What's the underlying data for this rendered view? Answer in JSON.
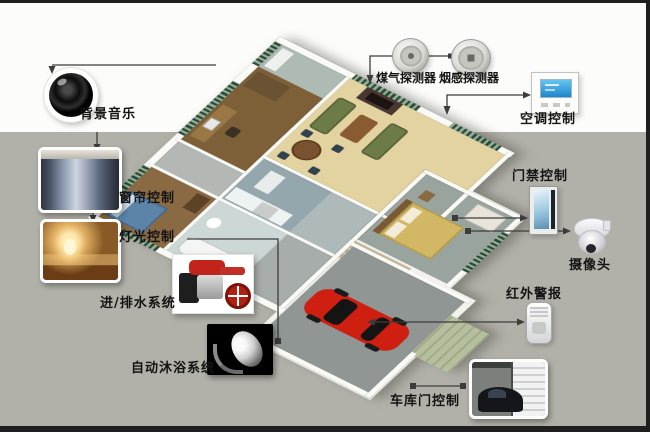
{
  "diagram": {
    "type": "smart-home-system-diagram",
    "scene": "isometric-house-floorplan"
  },
  "callouts": {
    "background_music": {
      "label": "背景音乐",
      "icon": "speaker-icon"
    },
    "curtain_control": {
      "label": "窗帘控制",
      "icon": "curtain-photo"
    },
    "light_control": {
      "label": "灯光控制",
      "icon": "lamp-room-photo"
    },
    "water_system": {
      "label": "进/排水系统",
      "icon": "water-pump-photo"
    },
    "auto_bath_system": {
      "label": "自动沐浴系统",
      "icon": "shower-head-photo"
    },
    "gas_detector": {
      "label": "煤气探测器",
      "icon": "gas-detector-icon"
    },
    "smoke_detector": {
      "label": "烟感探测器",
      "icon": "smoke-detector-icon"
    },
    "ac_control": {
      "label": "空调控制",
      "icon": "thermostat-icon"
    },
    "door_access_control": {
      "label": "门禁控制",
      "icon": "door-photo"
    },
    "camera": {
      "label": "摄像头",
      "icon": "dome-camera-icon"
    },
    "infrared_alarm": {
      "label": "红外警报",
      "icon": "pir-sensor-icon"
    },
    "garage_door_control": {
      "label": "车库门控制",
      "icon": "garage-door-photo"
    }
  },
  "colors": {
    "background_top": "#fcfcfa",
    "background_bottom": "#b1b1a9",
    "frame_border": "#1f1f1f",
    "line": "#3c3c3c",
    "label_text": "#141414",
    "car_red": "#cf1f10",
    "window_green": "#2d4a38",
    "living_floor": "#e2d3a0"
  }
}
